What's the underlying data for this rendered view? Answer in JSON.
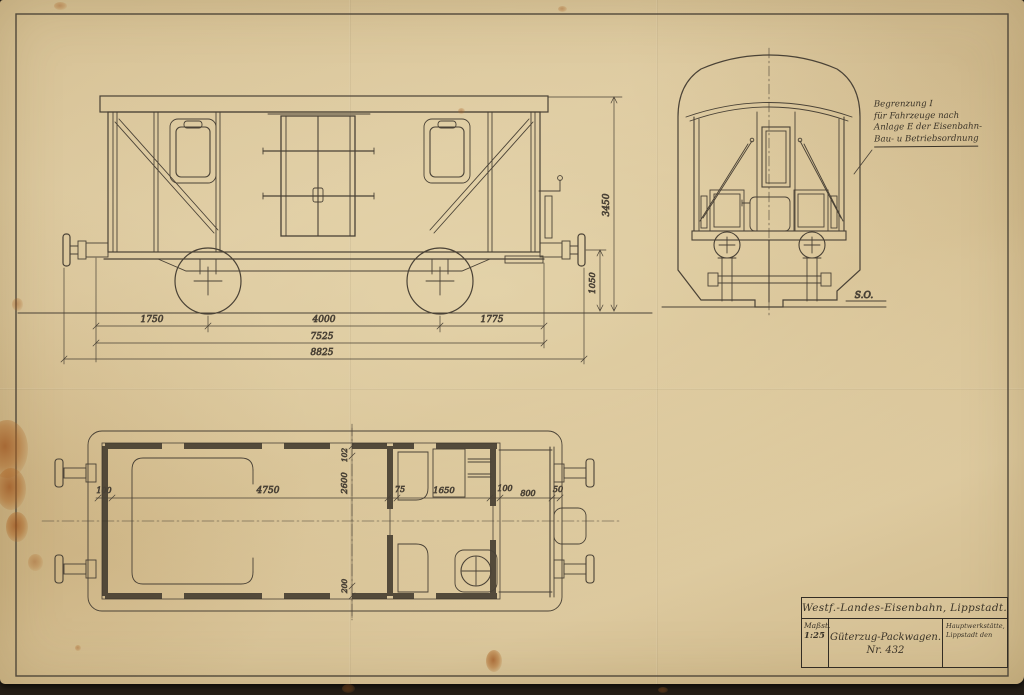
{
  "colors": {
    "paper": "#d8c49a",
    "ink": "#4a4236",
    "stain": "#a8632a"
  },
  "annotation_block": {
    "line1": "Begrenzung I",
    "line2": "für Fahrzeuge nach",
    "line3": "Anlage E der Eisenbahn-",
    "line4": "Bau- u Betriebsordnung"
  },
  "dimensions": {
    "side": {
      "left_overhang": "1750",
      "wheelbase": "4000",
      "right_overhang": "1775",
      "frame_length": "7525",
      "buffer_length": "8825",
      "body_height": "3450",
      "buffer_height": "1050"
    },
    "plan": {
      "wall_left": "100",
      "interior_length": "4750",
      "partition": "75",
      "service_compartment": "1650",
      "wall_mid": "100",
      "platform": "800",
      "end_post": "50",
      "plank": "102",
      "interior_width": "2600",
      "sill": "200"
    }
  },
  "end_view": {
    "marker": "S.O."
  },
  "title_block": {
    "company": "Westf.-Landes-Eisenbahn, Lippstadt.",
    "scale_label": "Maßst.",
    "scale_value": "1:25",
    "title": "Güterzug-Packwagen.",
    "number": "Nr. 432",
    "workshop_line1": "Hauptwerkstätte,",
    "workshop_line2": "Lippstadt den"
  }
}
